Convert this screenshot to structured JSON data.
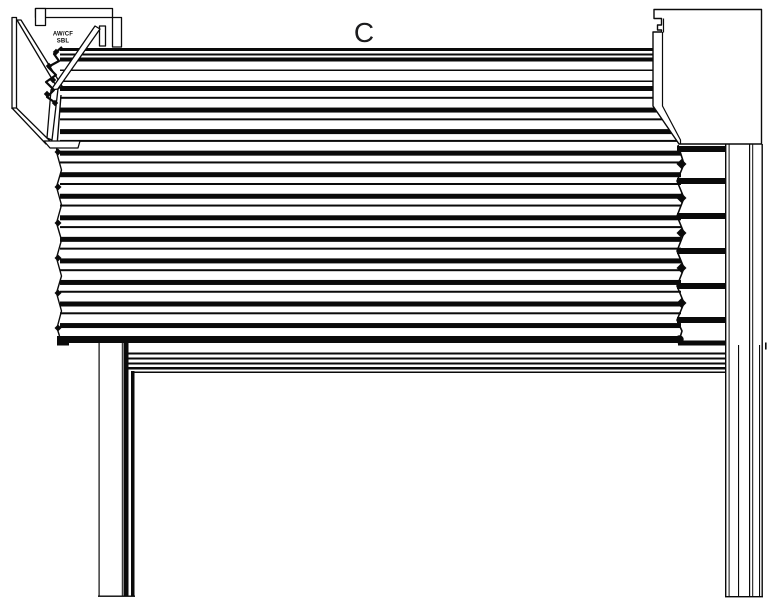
{
  "colors": {
    "ink": "#0a0a0a",
    "paper": "#ffffff"
  },
  "labels": {
    "section_label": "C",
    "bracket_text_line1": "AW/CF",
    "bracket_text_line2": "SBL"
  }
}
